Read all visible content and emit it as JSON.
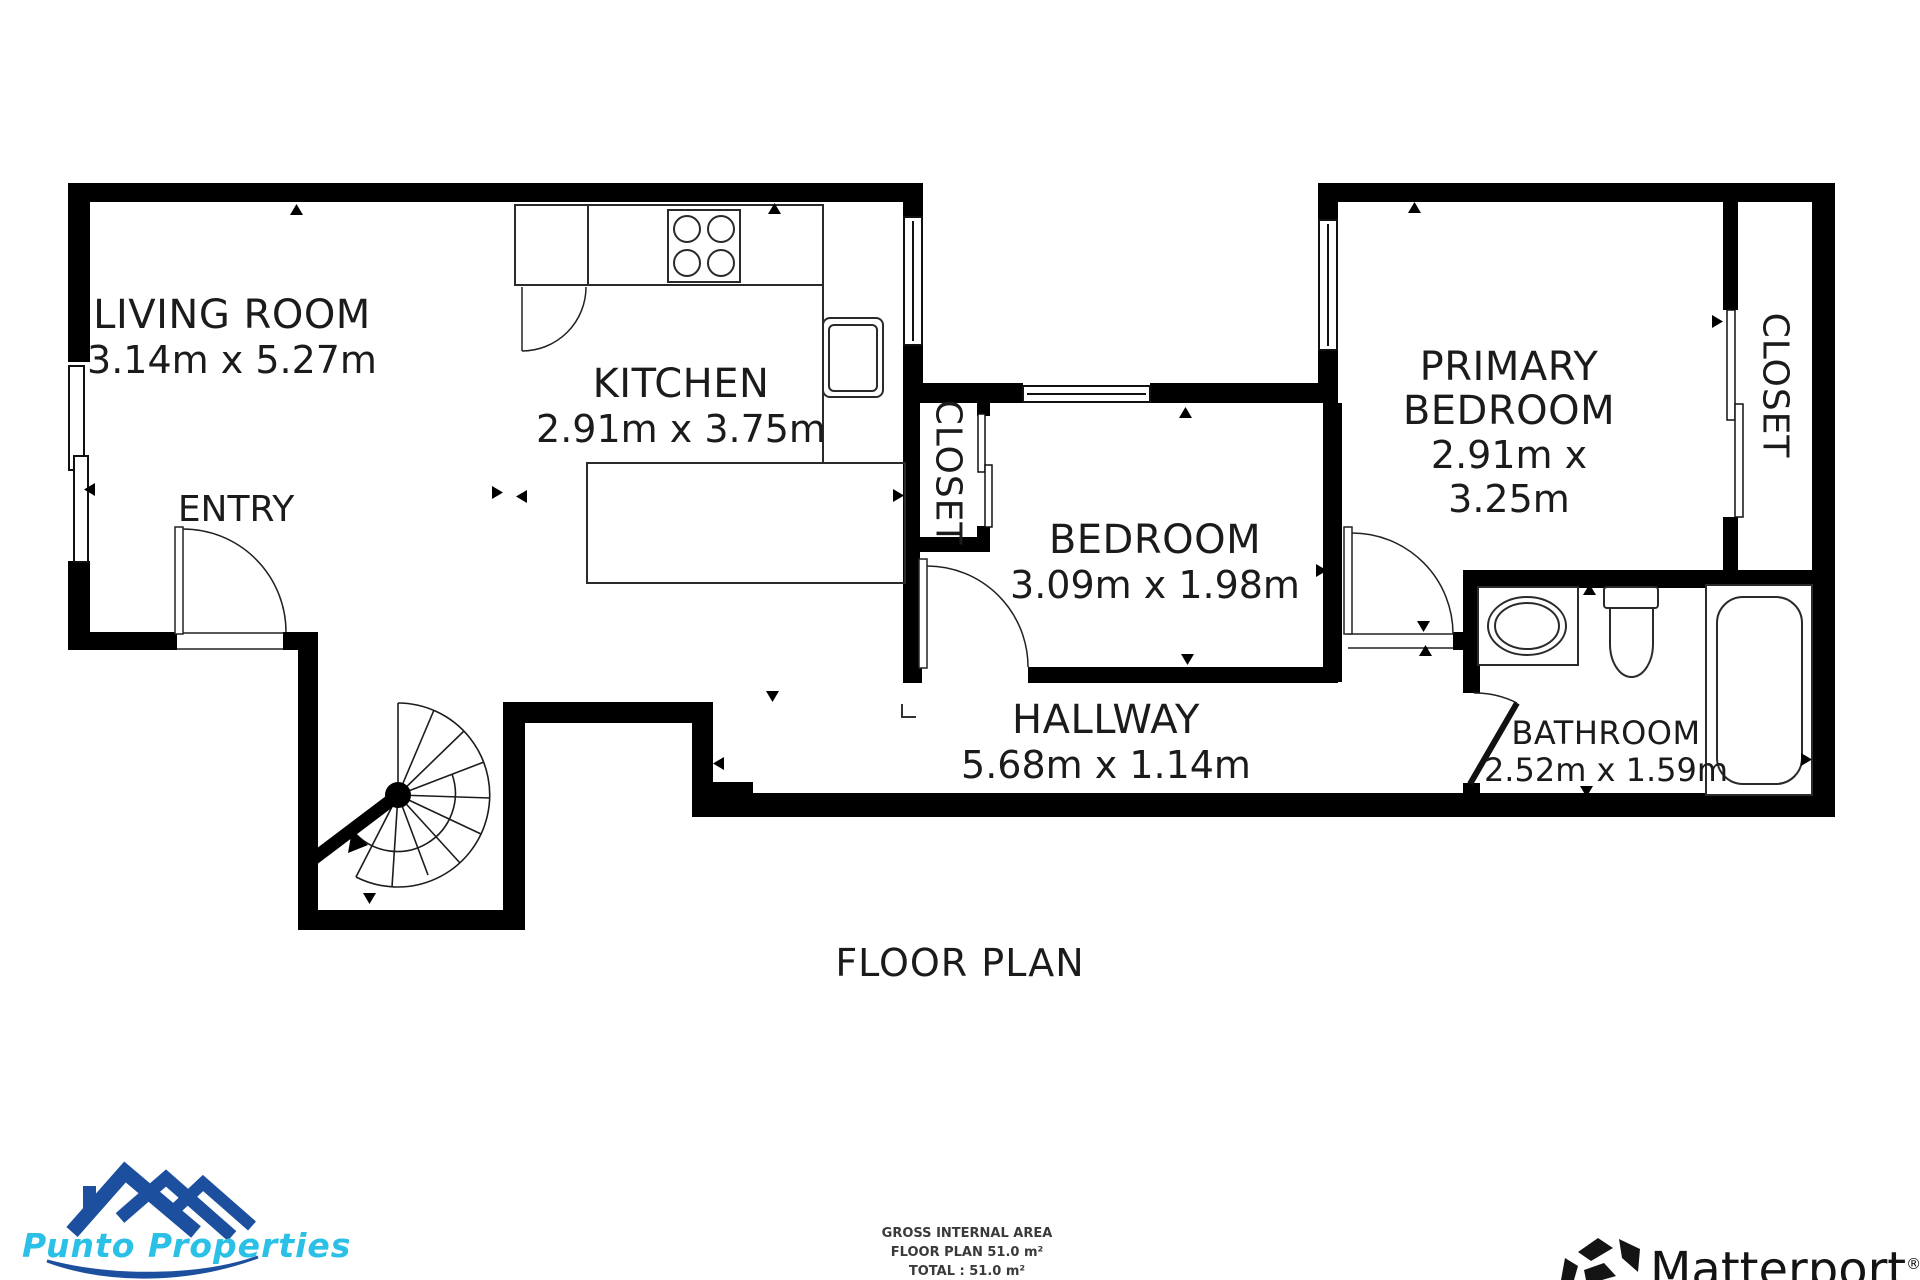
{
  "title": {
    "text": "FLOOR PLAN"
  },
  "rooms": {
    "living_room": {
      "name": "LIVING ROOM",
      "dims": "3.14m x 5.27m"
    },
    "kitchen": {
      "name": "KITCHEN",
      "dims": "2.91m x 3.75m"
    },
    "entry": {
      "name": "ENTRY"
    },
    "closet_left": {
      "name": "CLOSET"
    },
    "bedroom": {
      "name": "BEDROOM",
      "dims": "3.09m x 1.98m"
    },
    "primary_bedroom": {
      "name": "PRIMARY BEDROOM",
      "dims": "2.91m x 3.25m"
    },
    "closet_right": {
      "name": "CLOSET"
    },
    "bathroom": {
      "name": "BATHROOM",
      "dims": "2.52m x 1.59m"
    },
    "hallway": {
      "name": "HALLWAY",
      "dims": "5.68m x 1.14m"
    }
  },
  "footer": {
    "line1": "GROSS INTERNAL AREA",
    "line2": "FLOOR PLAN 51.0 m²",
    "line3": "TOTAL :  51.0 m²"
  },
  "brands": {
    "punto": {
      "name": "Punto Properties",
      "blue": "#1d4f9f",
      "cyan": "#2bc0e6"
    },
    "matterport": {
      "name": "Matterport",
      "reg": "®"
    }
  },
  "plan": {
    "wall_color": "#000000",
    "fixture_line_color": "#2a2a2a"
  }
}
